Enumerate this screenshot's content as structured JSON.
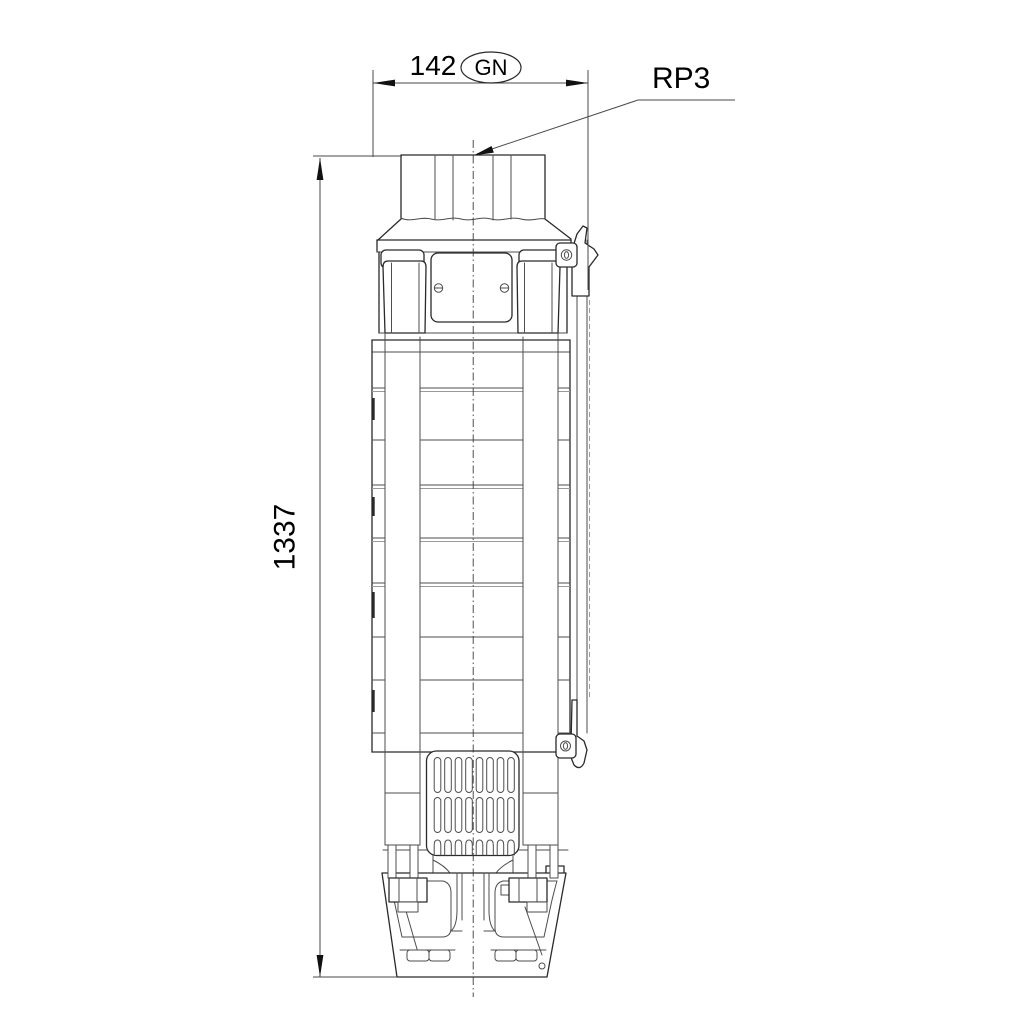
{
  "meta": {
    "kind": "technical dimensional drawing",
    "subject": "submersible borehole pump, front view",
    "background_color": "#ffffff",
    "line_color": "#2a2a2a",
    "text_color": "#000000"
  },
  "dimensions": {
    "width": {
      "value": "142",
      "badge": "GN"
    },
    "height": {
      "value": "1337"
    }
  },
  "callouts": {
    "connection": "RP3"
  }
}
